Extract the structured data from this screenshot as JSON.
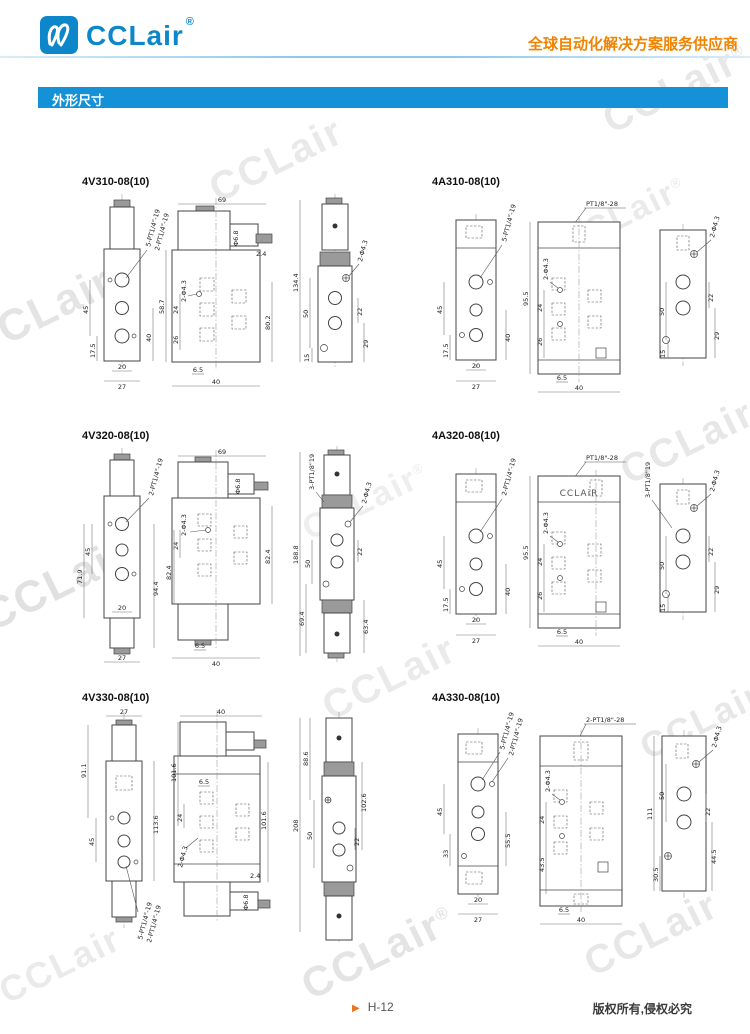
{
  "header": {
    "logo_text": "CCLair",
    "logo_reg": "®",
    "tagline": "全球自动化解决方案服务供应商"
  },
  "section": {
    "title": "外形尺寸"
  },
  "watermark": {
    "text": "CCLair",
    "reg": "®"
  },
  "footer": {
    "marker": "▶",
    "page": "H-12",
    "copyright": "版权所有,侵权必究"
  },
  "colors": {
    "brand_blue": "#0d87ca",
    "accent_orange": "#f08300",
    "bar_blue": "#1591d8"
  },
  "figures": [
    {
      "id": "4V310-08(10)",
      "labels": {
        "l": [
          "5-PT1/4\"-19",
          "2-PT1/4\"-19",
          "45",
          "17.5",
          "40",
          "20",
          "27"
        ],
        "m": [
          "69",
          "2-Φ4.3",
          "Φ6.8",
          "2.4",
          "58.7",
          "24",
          "26",
          "80.2",
          "6.5",
          "40"
        ],
        "r": [
          "134.4",
          "2-Φ4.3",
          "50",
          "15",
          "22",
          "29"
        ]
      }
    },
    {
      "id": "4A310-08(10)",
      "labels": {
        "l": [
          "5-PT1/4\"-19",
          "45",
          "17.5",
          "40",
          "20",
          "27"
        ],
        "m": [
          "PT1/8\"-28",
          "95.5",
          "2-Φ4.3",
          "24",
          "26",
          "6.5",
          "40"
        ],
        "r": [
          "2-Φ4.3",
          "50",
          "15",
          "22",
          "29"
        ]
      }
    },
    {
      "id": "4V320-08(10)",
      "labels": {
        "l": [
          "2-PT1/4\"-19",
          "45",
          "71.9",
          "94.4",
          "20",
          "27"
        ],
        "m": [
          "69",
          "Φ6.8",
          "2-Φ4.3",
          "24",
          "82.4",
          "82.4",
          "6.5",
          "40"
        ],
        "r": [
          "188.8",
          "3-PT1/8\"19",
          "2-Φ4.3",
          "50",
          "22",
          "69.4",
          "63.4"
        ]
      }
    },
    {
      "id": "4A320-08(10)",
      "labels": {
        "l": [
          "2-PT1/4\"-19",
          "45",
          "17.5",
          "40",
          "20",
          "27"
        ],
        "m": [
          "PT1/8\"-28",
          "CCLAiR",
          "95.5",
          "2-Φ4.3",
          "24",
          "26",
          "6.5",
          "40"
        ],
        "r": [
          "3-PT1/8\"19",
          "2-Φ4.3",
          "50",
          "15",
          "22",
          "29"
        ]
      }
    },
    {
      "id": "4V330-08(10)",
      "labels": {
        "l": [
          "27",
          "91.1",
          "45",
          "113.6",
          "5-PT1/4\"-19",
          "2-PT1/4\"-19"
        ],
        "m": [
          "40",
          "101.6",
          "6.5",
          "24",
          "2-Φ4.3",
          "101.6",
          "2.4",
          "Φ6.8"
        ],
        "r": [
          "208",
          "88.6",
          "50",
          "102.6",
          "22"
        ]
      }
    },
    {
      "id": "4A330-08(10)",
      "labels": {
        "l": [
          "5-PT1/4\"-19",
          "2-PT1/4\"-19",
          "45",
          "33",
          "55.5",
          "20",
          "27"
        ],
        "m": [
          "2-PT1/8\"-28",
          "2-Φ4.3",
          "24",
          "43.5",
          "6.5",
          "40"
        ],
        "r": [
          "2-Φ4.3",
          "111",
          "50",
          "30.5",
          "22",
          "44.5"
        ]
      }
    }
  ]
}
